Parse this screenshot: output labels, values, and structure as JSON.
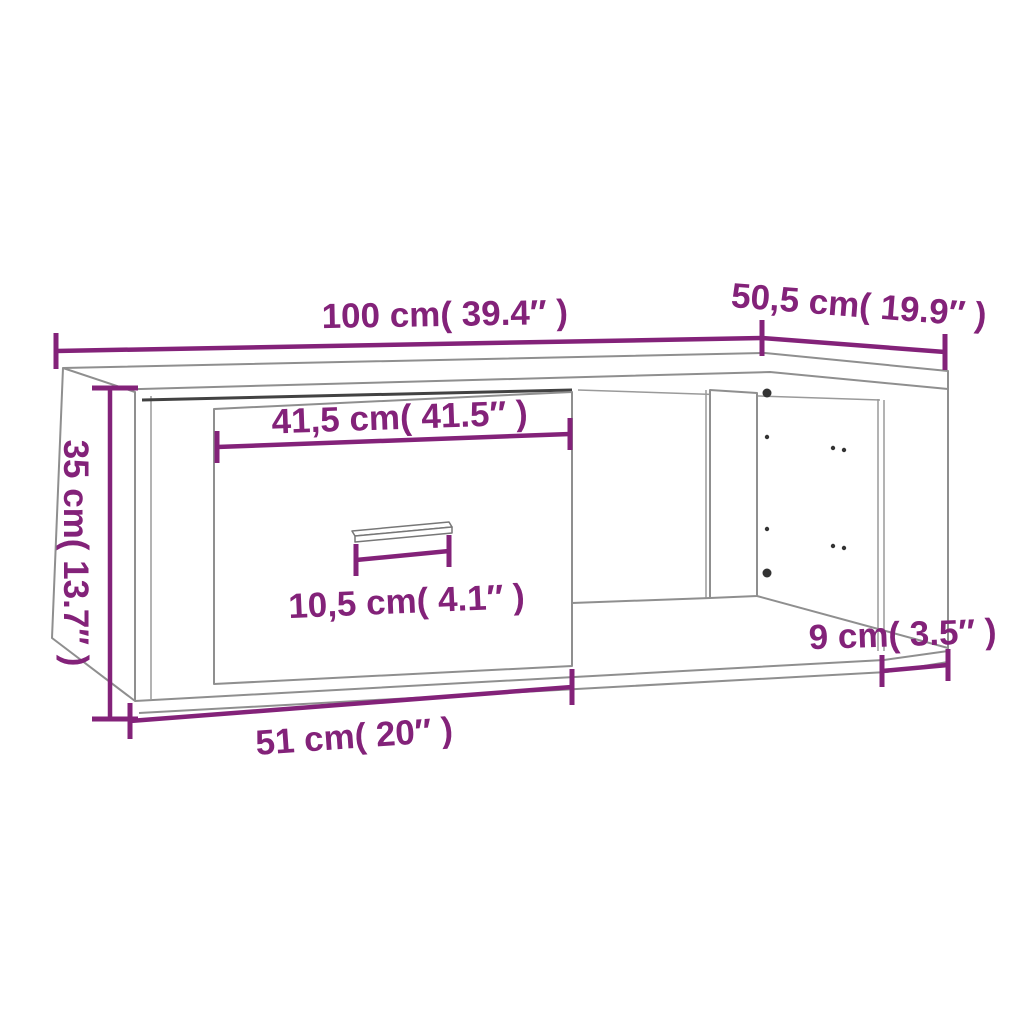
{
  "colors": {
    "annotation": "#832279",
    "line": "#8f8f8f",
    "dark_line": "#424242",
    "background": "#ffffff"
  },
  "dimensions": {
    "overall_width": {
      "label": "100 cm( 39.4″ )",
      "cm": "100",
      "inches": "39.4″"
    },
    "depth": {
      "label": "50,5 cm( 19.9″ )",
      "cm": "50,5",
      "inches": "19.9″"
    },
    "height": {
      "label": "35 cm( 13.7″ )",
      "cm": "35",
      "inches": "13.7″"
    },
    "drawer_front_width": {
      "label": "41,5 cm( 41.5″ )",
      "cm": "41,5",
      "inches": "41.5″"
    },
    "handle_width": {
      "label": "10,5 cm( 4.1″ )",
      "cm": "10,5",
      "inches": "4.1″"
    },
    "side_recess": {
      "label": "9 cm( 3.5″ )",
      "cm": "9",
      "inches": "3.5″"
    },
    "drawer_bottom_width": {
      "label": "51 cm( 20″ )",
      "cm": "51",
      "inches": "20″"
    }
  }
}
